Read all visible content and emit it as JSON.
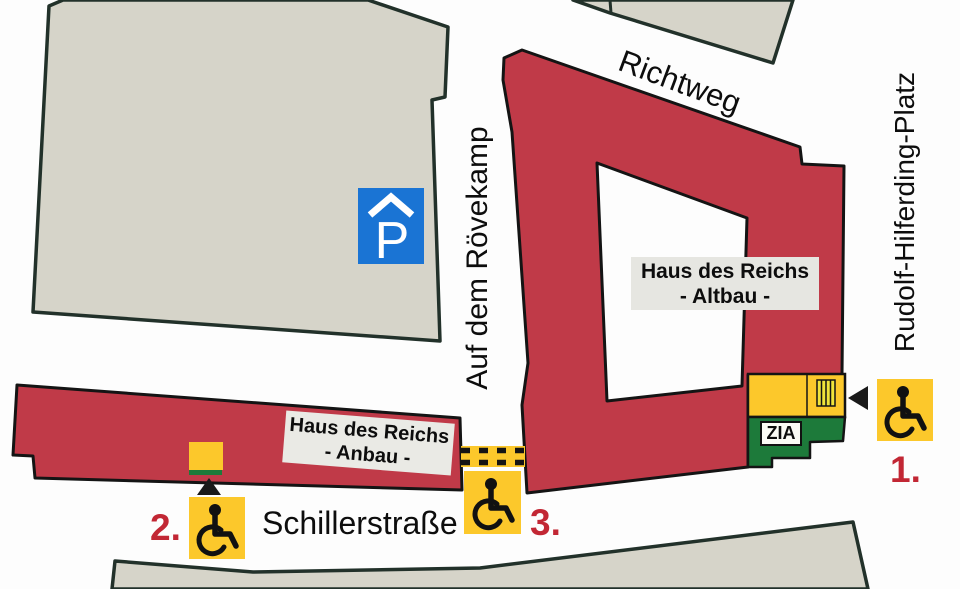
{
  "streets": {
    "richtweg": "Richtweg",
    "roevekamp": "Auf dem Rövekamp",
    "hilferding_platz": "Rudolf-Hilferding-Platz",
    "schillerstrasse": "Schillerstraße"
  },
  "buildings": {
    "altbau": {
      "line1": "Haus des Reichs",
      "line2": "- Altbau -"
    },
    "anbau": {
      "line1": "Haus des Reichs",
      "line2": "- Anbau -"
    },
    "zia_label": "ZIA",
    "parking_letter": "P"
  },
  "entrances": {
    "e1": "1.",
    "e2": "2.",
    "e3": "3."
  },
  "icons": {
    "parking_garage": "parking-garage-icon",
    "wheelchair": "wheelchair-accessible-icon",
    "arrow_left": "arrow-left-icon",
    "arrow_up": "arrow-up-icon"
  },
  "colors": {
    "building_red": "#c03a48",
    "building_gray": "#d6d4c9",
    "outline_dark": "#1c2420",
    "accessible_yellow": "#fcc82b",
    "zia_green": "#1d7a3a",
    "parking_blue": "#1a74d4",
    "marker_red": "#c22734",
    "label_gray_bg": "#e6e6e1"
  }
}
